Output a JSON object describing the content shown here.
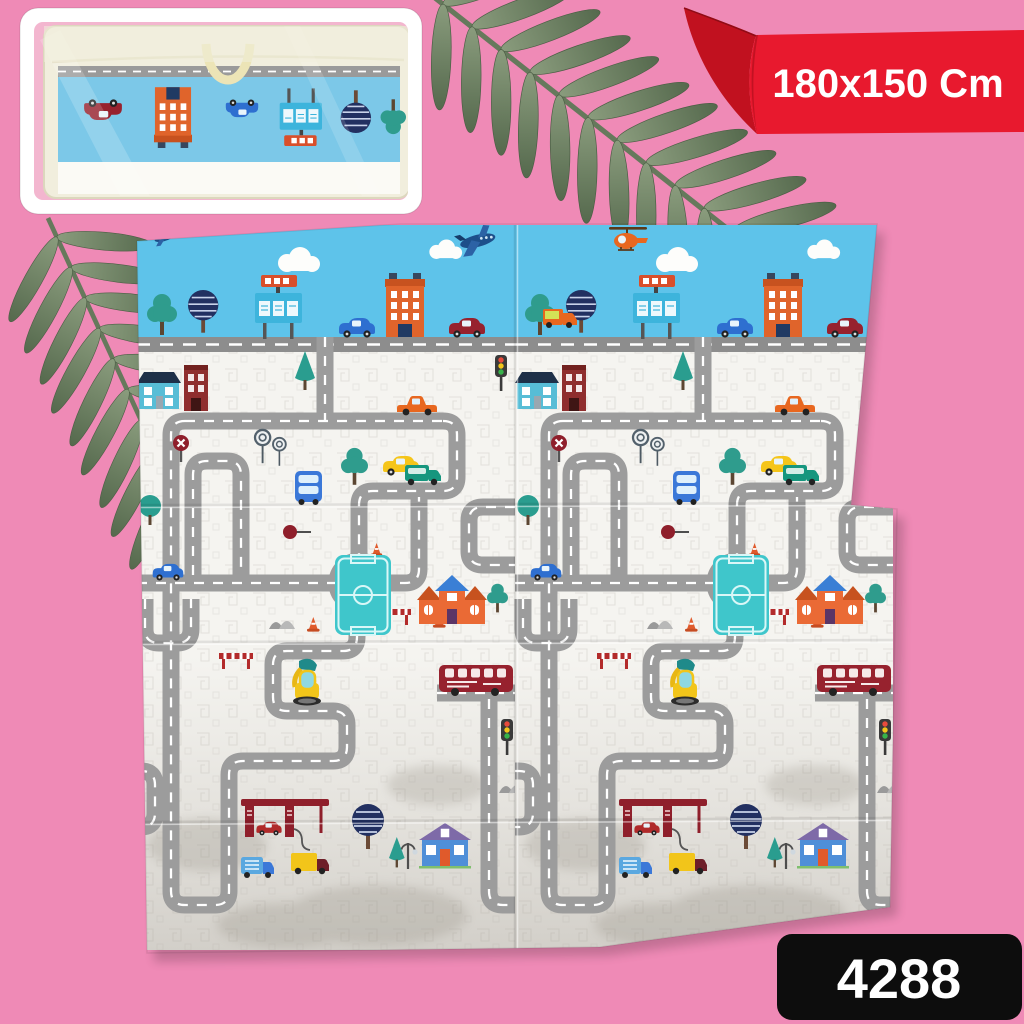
{
  "page": {
    "background_color": "#ef8ab6"
  },
  "ribbon": {
    "size_label": "180x150 Cm",
    "color": "#e8192e",
    "fold_color": "#c1111f",
    "text_color": "#ffffff"
  },
  "badge": {
    "number": "4288",
    "background": "#0d0d0d",
    "text_color": "#ffffff"
  },
  "inset": {
    "content_icon": "packed-playmat-in-carry-bag",
    "frame_color": "#ffffff",
    "bag_color": "#f1eedd",
    "mat_visible_color": "#7cc8e8"
  },
  "decor": {
    "leaves": [
      "fern-leaf-top",
      "fern-leaf-left"
    ],
    "leaf_color": "#6b7f5e"
  },
  "mat": {
    "panels": 2,
    "sky_color": "#5ec3ea",
    "ground_color": "#f5f4f0",
    "road_color": "#9c9c9c",
    "field_color": "#3fc6cb",
    "items": [
      "airplane",
      "helicopter",
      "clouds",
      "round-striped-tree",
      "green-tree",
      "billboard",
      "orange-building",
      "blue-house",
      "red-building",
      "cars",
      "pickup-truck",
      "delivery-trucks",
      "double-decker-bus",
      "roundabout",
      "soccer-field",
      "orange-house",
      "purple-roof-house",
      "excavator",
      "gas-station",
      "traffic-lights",
      "street-lamp",
      "traffic-cones",
      "road-barrier",
      "stop-sign",
      "lollipop-trees",
      "mountains"
    ]
  }
}
